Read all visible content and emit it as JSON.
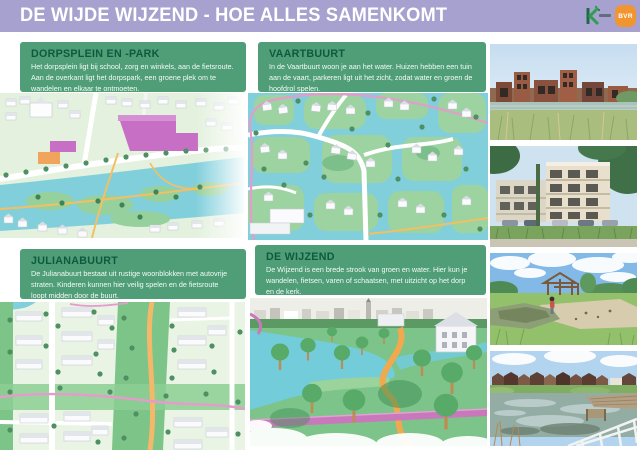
{
  "header": {
    "title": "DE WIJDE WIJZEND - HOE ALLES SAMENKOMT",
    "logos": [
      {
        "name": "municipality-k-logo",
        "text": ""
      },
      {
        "name": "bvr-logo",
        "text": "BVR"
      }
    ]
  },
  "quadrants": [
    {
      "id": "dorpsplein",
      "title": "DORPSPLEIN EN -PARK",
      "description": "Het dorpsplein ligt bij school, zorg en winkels, aan de fietsroute. Aan de overkant ligt het dorpspark, een groene plek om te wandelen en elkaar te ontmoeten."
    },
    {
      "id": "vaartbuurt",
      "title": "VAARTBUURT",
      "description": "In de Vaartbuurt woon je aan het water. Huizen hebben een tuin aan de vaart, parkeren ligt uit het zicht, zodat water en groen de hoofdrol spelen."
    },
    {
      "id": "julianabuurt",
      "title": "JULIANABUURT",
      "description": "De Julianabuurt bestaat uit rustige woonblokken met autovrije straten. Kinderen kunnen hier veilig spelen en de fietsroute loopt midden door de buurt."
    },
    {
      "id": "wijzend",
      "title": "DE WIJZEND",
      "description": "De Wijzend is een brede strook van groen en water. Hier kun je wandelen, fietsen, varen of schaatsen, met uitzicht op het dorp en de kerk."
    }
  ],
  "colors": {
    "header_bg": "#a7a1cf",
    "panel_bg": "#4f9e78",
    "panel_title": "#0e5a3e",
    "panel_text": "#f4faf6",
    "bvr_orange": "#f0952f",
    "logo_green": "#2f9e4f",
    "water": "#82cfdc",
    "grass_light": "#e3f1de",
    "grass_mid": "#8ccf94",
    "route_pink": "#e59bcb",
    "path_orange": "#f2b45f",
    "accent_magenta": "#c76fc5"
  }
}
